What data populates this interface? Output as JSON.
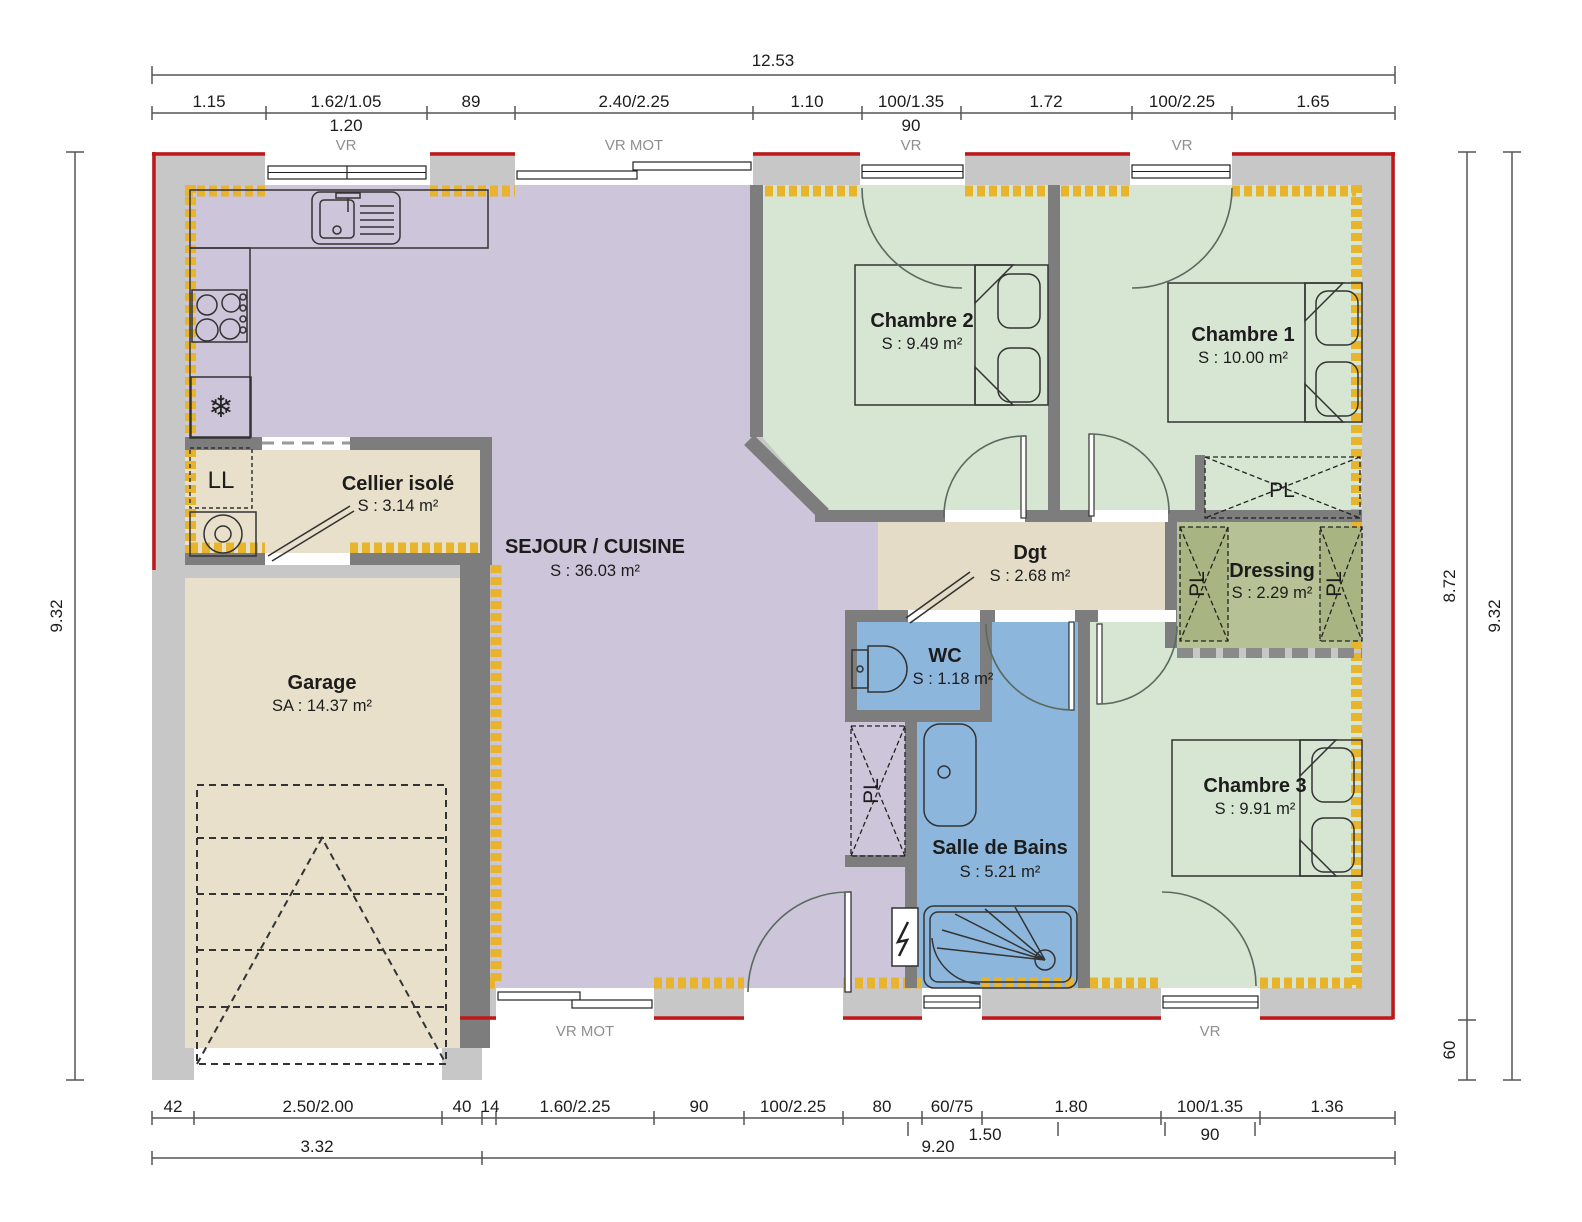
{
  "rooms": {
    "sejour": {
      "name": "SEJOUR / CUISINE",
      "area": "S : 36.03 m²"
    },
    "cellier": {
      "name": "Cellier isolé",
      "area": "S : 3.14 m²"
    },
    "garage": {
      "name": "Garage",
      "area": "SA : 14.37 m²"
    },
    "chambre2": {
      "name": "Chambre  2",
      "area": "S : 9.49 m²"
    },
    "chambre1": {
      "name": "Chambre  1",
      "area": "S : 10.00 m²"
    },
    "chambre3": {
      "name": "Chambre 3",
      "area": "S : 9.91 m²"
    },
    "dgt": {
      "name": "Dgt",
      "area": "S : 2.68 m²"
    },
    "dressing": {
      "name": "Dressing",
      "area": "S : 2.29 m²"
    },
    "wc": {
      "name": "WC",
      "area": "S : 1.18 m²"
    },
    "sdb": {
      "name": "Salle de Bains",
      "area": "S : 5.21 m²"
    }
  },
  "labels": {
    "pl": "PL",
    "ll": "LL",
    "vr": "VR",
    "vr_mot": "VR MOT"
  },
  "dims_top": {
    "total": "12.53",
    "segments": [
      "1.15",
      "1.62/1.05",
      "89",
      "2.40/2.25",
      "1.10",
      "100/1.35",
      "1.72",
      "100/2.25",
      "1.65"
    ],
    "sub_1": "1.20",
    "sub_2": "90",
    "vr_1": "VR",
    "vr_2": "VR MOT",
    "vr_3": "VR",
    "vr_4": "VR"
  },
  "dims_bottom": {
    "segments": [
      "42",
      "2.50/2.00",
      "40",
      "14",
      "1.60/2.25",
      "90",
      "100/2.25",
      "80",
      "60/75",
      "1.80",
      "100/1.35",
      "1.36"
    ],
    "sub_1": "1.50",
    "sub_2": "90",
    "total_1": "3.32",
    "total_2": "9.20",
    "wall_label_1": "VR MOT",
    "wall_label_2": "VR"
  },
  "dims_left": {
    "total": "9.32"
  },
  "dims_right": {
    "inner": "8.72",
    "offset": "60",
    "total": "9.32"
  },
  "colors": {
    "exterior_wall": "#c7c7c7",
    "interior_wall": "#7d7d7d",
    "living": "#cdc5da",
    "bedroom": "#d7e6d3",
    "service": "#e8e0ca",
    "hall": "#e4dcc6",
    "wet": "#8cb6db",
    "dressing": "#b6c295",
    "closet_olive": "#a8b583",
    "insulation": "#e8b42c",
    "envelope": "#c01818"
  }
}
